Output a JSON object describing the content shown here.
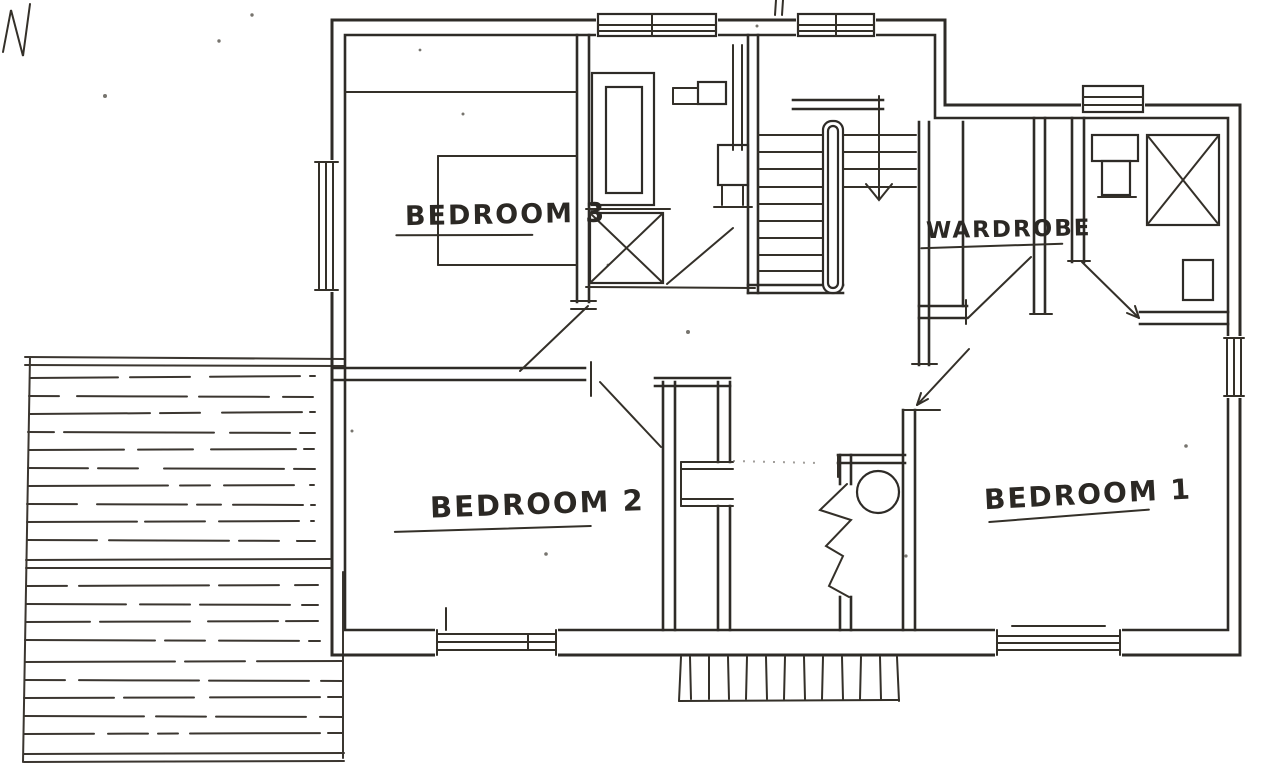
{
  "meta": {
    "description": "Hand-drawn architectural floor plan sketch (upper storey) with three bedrooms, wardrobe, bathroom, staircase and exterior deck"
  },
  "colors": {
    "paper": "#ffffff",
    "ink": "#2b2824"
  },
  "rooms": {
    "bedroom3": {
      "label": "BEDROOM 3"
    },
    "wardrobe": {
      "label": "WARDROBE"
    },
    "bedroom2": {
      "label": "BEDROOM 2"
    },
    "bedroom1": {
      "label": "BEDROOM 1"
    }
  }
}
